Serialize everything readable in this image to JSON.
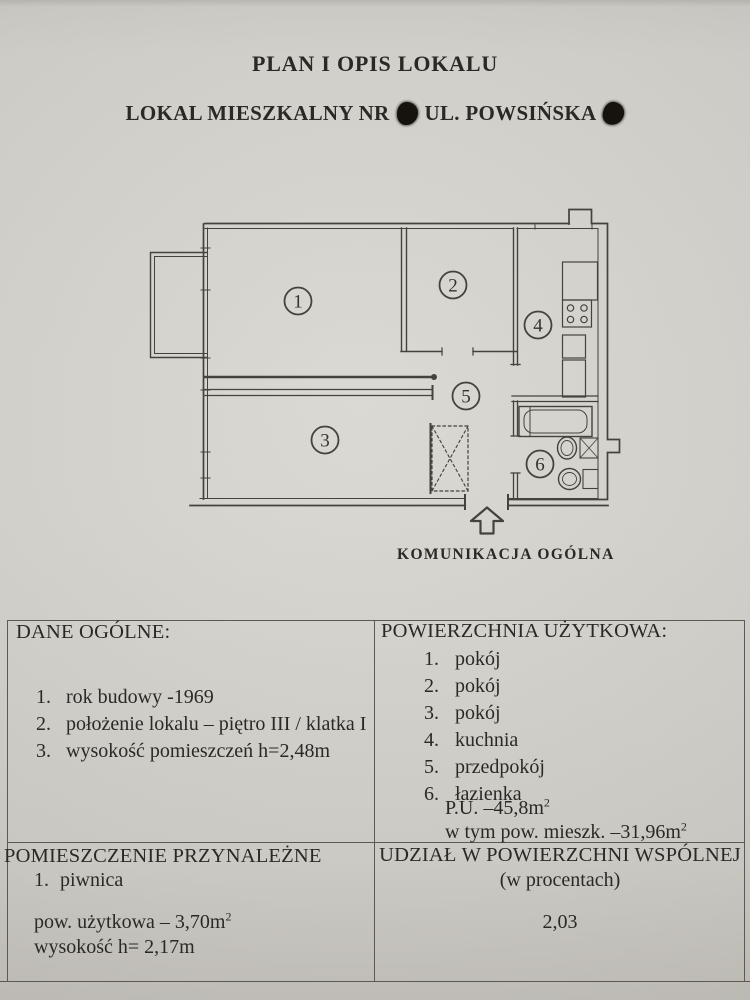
{
  "header": {
    "title": "PLAN I OPIS LOKALU",
    "subtitle_prefix": "LOKAL MIESZKALNY NR",
    "subtitle_street": "UL. POWSIŃSKA"
  },
  "plan": {
    "rooms": [
      "1",
      "2",
      "3",
      "4",
      "5",
      "6"
    ],
    "caption": "KOMUNIKACJA OGÓLNA"
  },
  "sections": {
    "dane_ogolne": {
      "header": "DANE OGÓLNE:",
      "items": [
        {
          "num": "1.",
          "text": "rok budowy -1969"
        },
        {
          "num": "2.",
          "text": "położenie lokalu – piętro III / klatka I"
        },
        {
          "num": "3.",
          "text": "wysokość pomieszczeń h=2,48m"
        }
      ]
    },
    "powierzchnia": {
      "header": "POWIERZCHNIA UŻYTKOWA:",
      "items": [
        {
          "num": "1.",
          "text": "pokój"
        },
        {
          "num": "2.",
          "text": "pokój"
        },
        {
          "num": "3.",
          "text": "pokój"
        },
        {
          "num": "4.",
          "text": "kuchnia"
        },
        {
          "num": "5.",
          "text": "przedpokój"
        },
        {
          "num": "6.",
          "text": "łazienka"
        }
      ],
      "pu_text": "P.U. –45,8m",
      "pu_sup": "2",
      "mieszk_text": "w tym pow. mieszk. –31,96m",
      "mieszk_sup": "2"
    },
    "przynalezne": {
      "header": "POMIESZCZENIE PRZYNALEŻNE",
      "items": [
        {
          "num": "1.",
          "text": "piwnica"
        }
      ],
      "area_text": "pow. użytkowa – 3,70m",
      "area_sup": "2",
      "height_text": "wysokość h= 2,17m"
    },
    "udzial": {
      "header_line1": "UDZIAŁ W POWIERZCHNI WSPÓLNEJ",
      "header_line2": "(w procentach)",
      "value": "2,03"
    }
  },
  "colors": {
    "paper": "#d6d4ce",
    "ink": "#2b2925",
    "plan_line": "#45423c"
  }
}
